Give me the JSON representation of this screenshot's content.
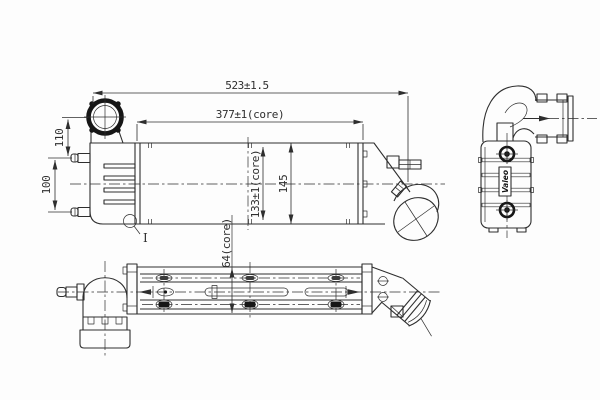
{
  "drawing": {
    "colors": {
      "line": "#2e2e2e",
      "dark": "#161616",
      "pill": "#3c3c3c",
      "background": "#fdfdfd"
    },
    "dimensions": {
      "overall_length": "523±1.5",
      "core_length": "377±1(core)",
      "port_offset": "110",
      "bracket_spacing": "100",
      "core_height": "133±1(core)",
      "overall_height": "145",
      "core_depth": "64(core)"
    },
    "labels": {
      "detail_marker": "I",
      "brand": "Valeo"
    }
  }
}
